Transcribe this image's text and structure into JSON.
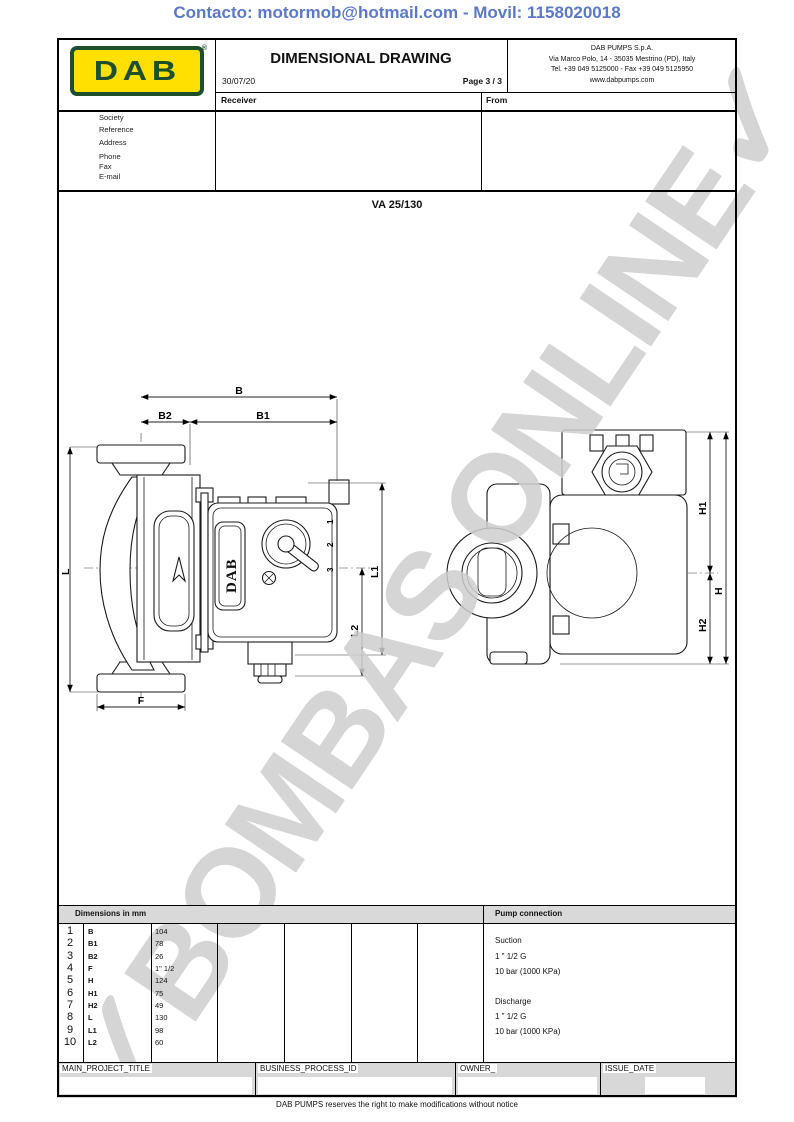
{
  "contact_header": "Contacto: motormob@hotmail.com - Movil: 1158020018",
  "colors": {
    "accent_blue": "#5b79c8",
    "dab_green": "#1d4f2a",
    "dab_yellow": "#ffe000",
    "bar_gray": "#d9d9d9",
    "watermark_gray": "#cecece"
  },
  "header": {
    "logo_text": "DAB",
    "logo_mark": "®",
    "title": "DIMENSIONAL DRAWING",
    "date": "30/07/2019",
    "page": "Page 3 / 3",
    "company_lines": [
      "DAB PUMPS S.p.A.",
      "Via Marco Polo, 14 - 35035 Mestrino (PD), Italy",
      "Tel. +39 049 5125000 - Fax +39 049 5125950",
      "www.dabpumps.com"
    ],
    "receiver_label": "Receiver",
    "from_label": "From",
    "contact_fields": [
      "Society",
      "Reference",
      "Address",
      "Phone",
      "Fax",
      "E-mail"
    ]
  },
  "model": "VA 25/130",
  "drawing": {
    "pump_logo": "DAB",
    "labels": {
      "B": "B",
      "B1": "B1",
      "B2": "B2",
      "L": "L",
      "F": "F",
      "L1": "L1",
      "L2": "L2",
      "H": "H",
      "H1": "H1",
      "H2": "H2"
    },
    "knob": {
      "k1": "1",
      "k2": "2",
      "k3": "3"
    }
  },
  "dimensions_table": {
    "header": "Dimensions in mm",
    "rows": [
      {
        "n": "1",
        "label": "B",
        "value": "104"
      },
      {
        "n": "2",
        "label": "B1",
        "value": "78"
      },
      {
        "n": "3",
        "label": "B2",
        "value": "26"
      },
      {
        "n": "4",
        "label": "F",
        "value": "1\" 1/2"
      },
      {
        "n": "5",
        "label": "H",
        "value": "124"
      },
      {
        "n": "6",
        "label": "H1",
        "value": "75"
      },
      {
        "n": "7",
        "label": "H2",
        "value": "49"
      },
      {
        "n": "8",
        "label": "L",
        "value": "130"
      },
      {
        "n": "9",
        "label": "L1",
        "value": "98"
      },
      {
        "n": "10",
        "label": "L2",
        "value": "60"
      }
    ]
  },
  "pump_connection": {
    "header": "Pump connection",
    "suction": {
      "label": "Suction",
      "size": "1 \" 1/2 G",
      "pressure": "10 bar (1000 KPa)"
    },
    "discharge": {
      "label": "Discharge",
      "size": "1 \" 1/2 G",
      "pressure": "10 bar (1000 KPa)"
    }
  },
  "footer": {
    "fields": [
      {
        "label": "MAIN_PROJECT_TITLE"
      },
      {
        "label": "BUSINESS_PROCESS_ID"
      },
      {
        "label": "OWNER_"
      },
      {
        "label": "ISSUE_DATE"
      }
    ],
    "disclaimer": "DAB PUMPS reserves the right to make modifications without notice"
  },
  "watermark": {
    "text": "BOMBAS ONLINE",
    "check_icon": "✓"
  }
}
